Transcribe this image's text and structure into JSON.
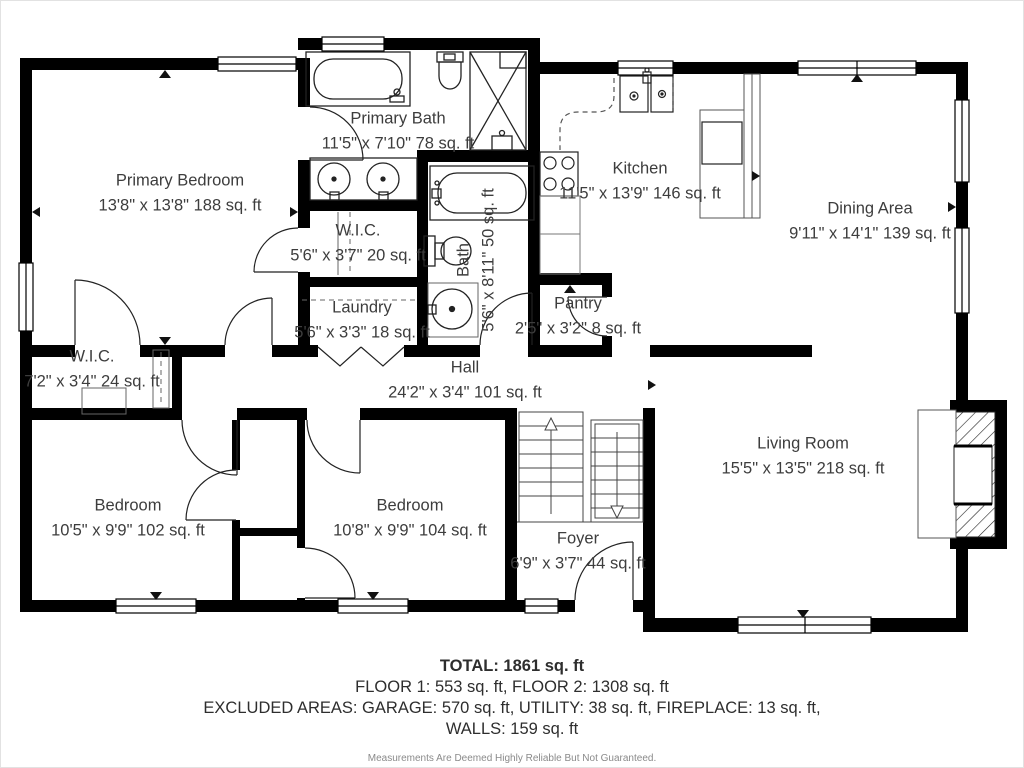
{
  "plan": {
    "title": "Floor plan",
    "rooms": [
      {
        "id": "primary-bedroom",
        "name": "Primary Bedroom",
        "dims": "13'8\" x 13'8\" 188 sq. ft"
      },
      {
        "id": "primary-bath",
        "name": "Primary Bath",
        "dims": "11'5\" x 7'10\" 78 sq. ft"
      },
      {
        "id": "wic-center",
        "name": "W.I.C.",
        "dims": "5'6\" x 3'7\" 20 sq. ft"
      },
      {
        "id": "laundry",
        "name": "Laundry",
        "dims": "5'6\" x 3'3\" 18 sq. ft"
      },
      {
        "id": "bath",
        "name": "Bath",
        "dims": "5'6\" x 8'11\" 50 sq. ft"
      },
      {
        "id": "kitchen",
        "name": "Kitchen",
        "dims": "11'5\" x 13'9\" 146 sq. ft"
      },
      {
        "id": "pantry",
        "name": "Pantry",
        "dims": "2'5\" x 3'2\" 8 sq. ft"
      },
      {
        "id": "dining-area",
        "name": "Dining Area",
        "dims": "9'11\" x 14'1\" 139 sq. ft"
      },
      {
        "id": "wic-left",
        "name": "W.I.C.",
        "dims": "7'2\" x 3'4\" 24 sq. ft"
      },
      {
        "id": "hall",
        "name": "Hall",
        "dims": "24'2\" x 3'4\" 101 sq. ft"
      },
      {
        "id": "bedroom-left",
        "name": "Bedroom",
        "dims": "10'5\" x 9'9\" 102 sq. ft"
      },
      {
        "id": "bedroom-right",
        "name": "Bedroom",
        "dims": "10'8\" x 9'9\" 104 sq. ft"
      },
      {
        "id": "foyer",
        "name": "Foyer",
        "dims": "6'9\" x 3'7\" 44 sq. ft"
      },
      {
        "id": "living-room",
        "name": "Living Room",
        "dims": "15'5\" x 13'5\" 218 sq. ft"
      }
    ],
    "summary": {
      "total": "TOTAL: 1861 sq. ft",
      "floors": "FLOOR 1: 553 sq. ft, FLOOR 2: 1308 sq. ft",
      "excluded": "EXCLUDED AREAS: GARAGE: 570 sq. ft, UTILITY: 38 sq. ft, FIREPLACE: 13 sq. ft,",
      "walls": "WALLS: 159 sq. ft",
      "disclaimer": "Measurements Are Deemed Highly Reliable But Not Guaranteed."
    },
    "colors": {
      "wall": "#000000",
      "fixture": "#222222",
      "text": "#3d3d3d",
      "disclaimer": "#8a8a8a"
    }
  }
}
